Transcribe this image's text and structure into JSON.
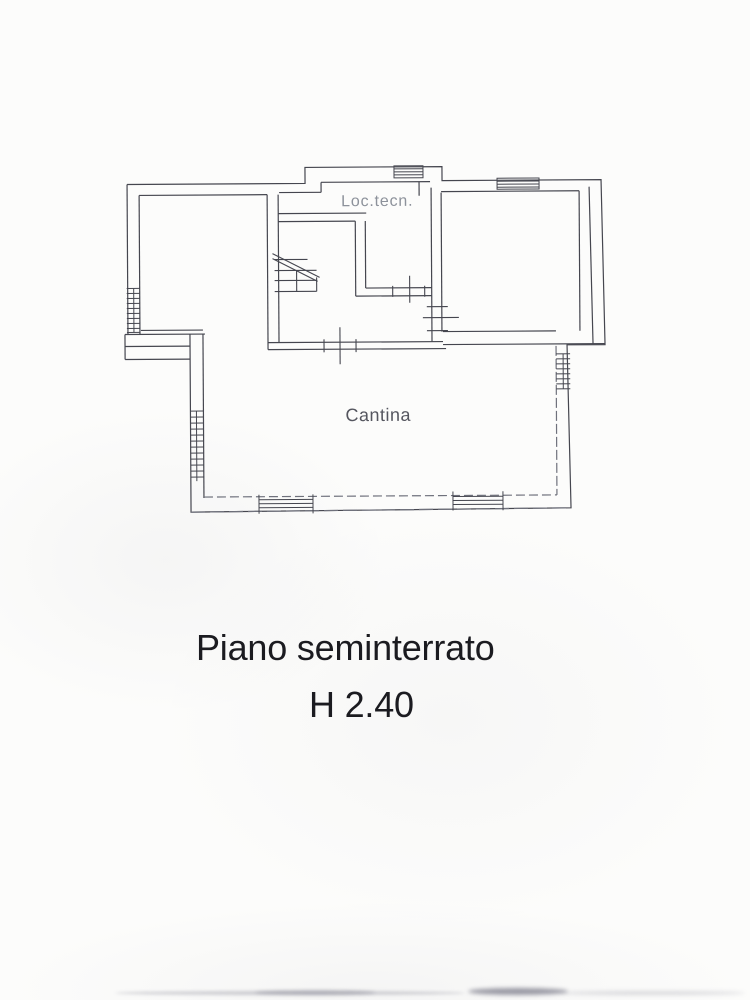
{
  "document": {
    "kind": "scanned cadastral floor plan",
    "labels": {
      "loc_tecn": "Loc.tecn.",
      "cantina": "Cantina"
    },
    "caption": {
      "line1": "Piano seminterrato",
      "line2": "H 2.40"
    },
    "colors": {
      "paper": "#fcfcfb",
      "wall_line": "#45464f",
      "faint_line": "#6f717c",
      "caption_text": "#1b1b20",
      "cantina_text": "#55565f",
      "loc_tecn_text": "#8d929b"
    }
  }
}
